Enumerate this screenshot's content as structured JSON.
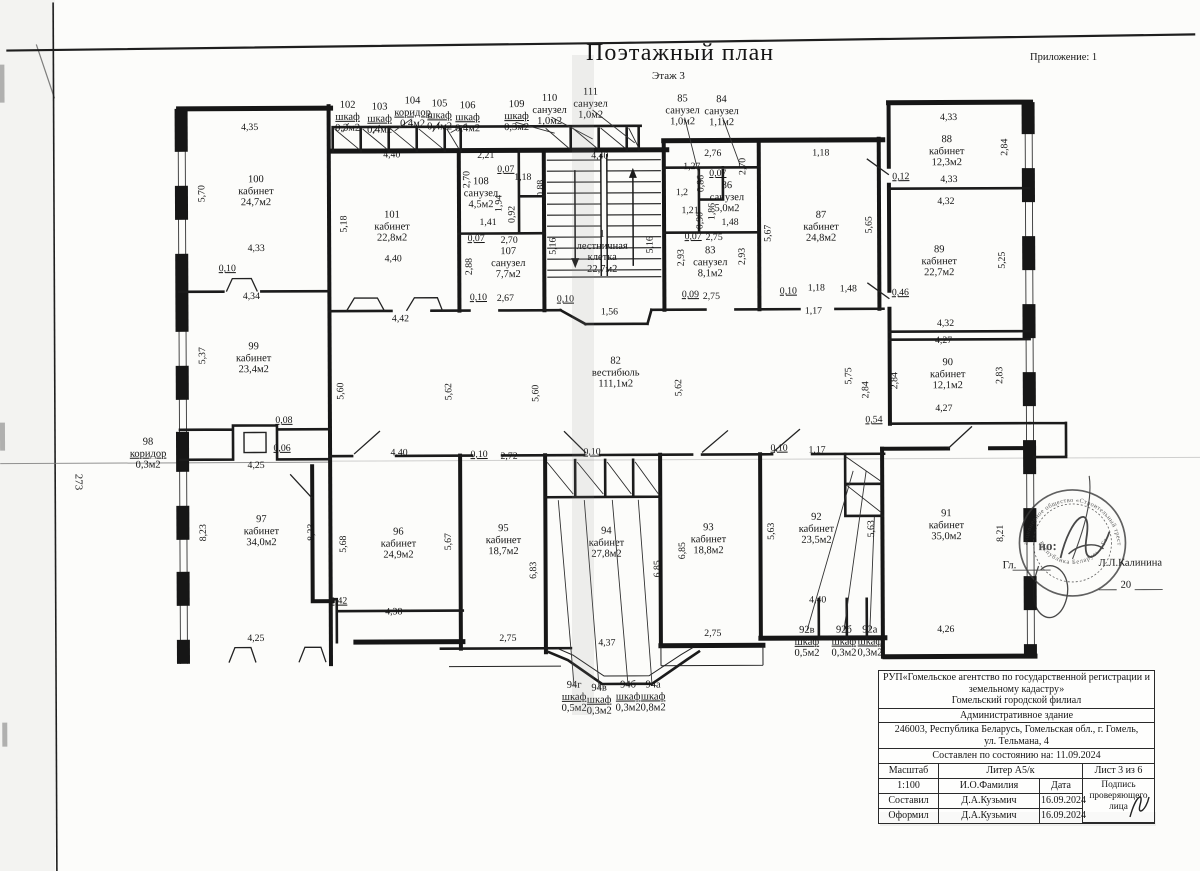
{
  "header": {
    "title": "Поэтажный план",
    "floor": "Этаж 3",
    "annex": "Приложение: 1"
  },
  "side_note": "273",
  "plan": {
    "rooms": [
      {
        "n": "100",
        "t": "кабинет",
        "a": "24,7м2",
        "x": 257,
        "y": 190
      },
      {
        "n": "101",
        "t": "кабинет",
        "a": "22,8м2",
        "x": 393,
        "y": 226
      },
      {
        "n": "108",
        "t": "санузел",
        "a": "4,5м2",
        "x": 482,
        "y": 193
      },
      {
        "n": "107",
        "t": "санузел",
        "a": "7,7м2",
        "x": 509,
        "y": 263
      },
      {
        "n": "1",
        "t": "лестничная",
        "t2": "клетка",
        "a": "22,7м2",
        "x": 603,
        "y": 252
      },
      {
        "n": "86",
        "t": "санузел",
        "a": "5,0м2",
        "x": 728,
        "y": 198
      },
      {
        "n": "83",
        "t": "санузел",
        "a": "8,1м2",
        "x": 711,
        "y": 263
      },
      {
        "n": "87",
        "t": "кабинет",
        "a": "24,8м2",
        "x": 822,
        "y": 228
      },
      {
        "n": "88",
        "t": "кабинет",
        "a": "12,3м2",
        "x": 948,
        "y": 153
      },
      {
        "n": "89",
        "t": "кабинет",
        "a": "22,7м2",
        "x": 940,
        "y": 263
      },
      {
        "n": "90",
        "t": "кабинет",
        "a": "12,1м2",
        "x": 948,
        "y": 376
      },
      {
        "n": "82",
        "t": "вестибюль",
        "a": "111,1м2",
        "x": 616,
        "y": 373
      },
      {
        "n": "99",
        "t": "кабинет",
        "a": "23,4м2",
        "x": 254,
        "y": 357
      },
      {
        "n": "98",
        "t": "коридор",
        "a": "0,3м2",
        "x": 148,
        "y": 452,
        "u": 1
      },
      {
        "n": "97",
        "t": "кабинет",
        "a": "34,0м2",
        "x": 261,
        "y": 530
      },
      {
        "n": "96",
        "t": "кабинет",
        "a": "24,9м2",
        "x": 398,
        "y": 543
      },
      {
        "n": "95",
        "t": "кабинет",
        "a": "18,7м2",
        "x": 503,
        "y": 540
      },
      {
        "n": "94",
        "t": "кабинет",
        "a": "27,8м2",
        "x": 606,
        "y": 543
      },
      {
        "n": "93",
        "t": "кабинет",
        "a": "18,8м2",
        "x": 708,
        "y": 540
      },
      {
        "n": "92",
        "t": "кабинет",
        "a": "23,5м2",
        "x": 816,
        "y": 530
      },
      {
        "n": "91",
        "t": "кабинет",
        "a": "35,0м2",
        "x": 946,
        "y": 527
      },
      {
        "n": "102",
        "t": "шкаф",
        "a": "0,3м2",
        "x": 349,
        "y": 116,
        "u": 1
      },
      {
        "n": "103",
        "t": "шкаф",
        "a": "0,4м2",
        "x": 381,
        "y": 118,
        "u": 1
      },
      {
        "n": "104",
        "t": "коридор",
        "a": "0,4м2",
        "x": 414,
        "y": 112,
        "u": 1
      },
      {
        "n": "105",
        "t": "шкаф",
        "a": "0,4м2",
        "x": 441,
        "y": 115,
        "u": 1
      },
      {
        "n": "106",
        "t": "шкаф",
        "a": "0,4м2",
        "x": 469,
        "y": 117,
        "u": 1
      },
      {
        "n": "109",
        "t": "шкаф",
        "a": "0,3м2",
        "x": 518,
        "y": 116,
        "u": 1
      },
      {
        "n": "110",
        "t": "санузел",
        "a": "1,0м2",
        "x": 551,
        "y": 110
      },
      {
        "n": "111",
        "t": "санузел",
        "a": "1,0м2",
        "x": 592,
        "y": 104
      },
      {
        "n": "85",
        "t": "санузел",
        "a": "1,0м2",
        "x": 684,
        "y": 111
      },
      {
        "n": "84",
        "t": "санузел",
        "a": "1,1м2",
        "x": 723,
        "y": 112
      },
      {
        "n": "92в",
        "t": "шкаф",
        "a": "0,5м2",
        "x": 806,
        "y": 643,
        "u": 1
      },
      {
        "n": "92б",
        "t": "шкаф",
        "a": "0,3м2",
        "x": 843,
        "y": 643,
        "u": 1
      },
      {
        "n": "92а",
        "t": "шкаф",
        "a": "0,3м2",
        "x": 869,
        "y": 643,
        "u": 1
      },
      {
        "n": "94г",
        "t": "шкаф",
        "a": "0,5м2",
        "x": 573,
        "y": 697,
        "u": 1
      },
      {
        "n": "94в",
        "t": "шкаф",
        "a": "0,3м2",
        "x": 598,
        "y": 700,
        "u": 1
      },
      {
        "n": "94б",
        "t": "шкаф",
        "a": "0,3м2",
        "x": 627,
        "y": 697,
        "u": 1
      },
      {
        "n": "94а",
        "t": "шкаф",
        "a": "0,8м2",
        "x": 652,
        "y": 697,
        "u": 1
      }
    ],
    "dims": [
      {
        "t": "4,35",
        "x": 251,
        "y": 126
      },
      {
        "t": "5,70",
        "x": 203,
        "y": 192,
        "r": 1
      },
      {
        "t": "4,33",
        "x": 257,
        "y": 247
      },
      {
        "t": "0,10",
        "x": 228,
        "y": 267,
        "u": 1
      },
      {
        "t": "4,34",
        "x": 252,
        "y": 295
      },
      {
        "t": "4,40",
        "x": 393,
        "y": 154
      },
      {
        "t": "5,18",
        "x": 345,
        "y": 223,
        "r": 1
      },
      {
        "t": "4,40",
        "x": 394,
        "y": 258
      },
      {
        "t": "4,42",
        "x": 401,
        "y": 318
      },
      {
        "t": "2,21",
        "x": 487,
        "y": 155
      },
      {
        "t": "0,07",
        "x": 507,
        "y": 169,
        "u": 1
      },
      {
        "t": "2,70",
        "x": 468,
        "y": 179,
        "r": 1
      },
      {
        "t": "1,18",
        "x": 524,
        "y": 177
      },
      {
        "t": "0,88",
        "x": 542,
        "y": 188,
        "r": 1
      },
      {
        "t": "1,94",
        "x": 500,
        "y": 203,
        "r": 1
      },
      {
        "t": "0,92",
        "x": 513,
        "y": 214,
        "r": 1
      },
      {
        "t": "1,41",
        "x": 489,
        "y": 222
      },
      {
        "t": "0,07",
        "x": 477,
        "y": 238,
        "u": 1
      },
      {
        "t": "2,70",
        "x": 510,
        "y": 240
      },
      {
        "t": "2,88",
        "x": 470,
        "y": 266,
        "r": 1
      },
      {
        "t": "0,10",
        "x": 479,
        "y": 297,
        "u": 1
      },
      {
        "t": "2,67",
        "x": 506,
        "y": 298
      },
      {
        "t": "4,40",
        "x": 601,
        "y": 156
      },
      {
        "t": "5,16",
        "x": 554,
        "y": 246,
        "r": 1
      },
      {
        "t": "5,16",
        "x": 651,
        "y": 245,
        "r": 1
      },
      {
        "t": "0,10",
        "x": 566,
        "y": 299,
        "u": 1
      },
      {
        "t": "1,56",
        "x": 610,
        "y": 312
      },
      {
        "t": "2,76",
        "x": 714,
        "y": 154
      },
      {
        "t": "1,27",
        "x": 693,
        "y": 167
      },
      {
        "t": "0,07",
        "x": 719,
        "y": 174,
        "u": 1
      },
      {
        "t": "2,70",
        "x": 744,
        "y": 167,
        "r": 1
      },
      {
        "t": "0,86",
        "x": 702,
        "y": 184,
        "r": 1
      },
      {
        "t": "1,2",
        "x": 683,
        "y": 193
      },
      {
        "t": "1,21",
        "x": 691,
        "y": 211
      },
      {
        "t": "0,90",
        "x": 701,
        "y": 221,
        "r": 1
      },
      {
        "t": "1,86",
        "x": 713,
        "y": 212,
        "r": 1
      },
      {
        "t": "1,48",
        "x": 731,
        "y": 223
      },
      {
        "t": "0,07",
        "x": 694,
        "y": 237,
        "u": 1
      },
      {
        "t": "2,75",
        "x": 715,
        "y": 238
      },
      {
        "t": "2,93",
        "x": 682,
        "y": 258,
        "r": 1
      },
      {
        "t": "2,93",
        "x": 743,
        "y": 257,
        "r": 1
      },
      {
        "t": "0,09",
        "x": 691,
        "y": 295,
        "u": 1
      },
      {
        "t": "2,75",
        "x": 712,
        "y": 297
      },
      {
        "t": "1,18",
        "x": 822,
        "y": 154
      },
      {
        "t": "5,67",
        "x": 769,
        "y": 234,
        "r": 1
      },
      {
        "t": "5,65",
        "x": 870,
        "y": 226,
        "r": 1
      },
      {
        "t": "0,10",
        "x": 789,
        "y": 292,
        "u": 1
      },
      {
        "t": "1,18",
        "x": 817,
        "y": 289
      },
      {
        "t": "1,48",
        "x": 849,
        "y": 290
      },
      {
        "t": "1,17",
        "x": 814,
        "y": 312
      },
      {
        "t": "4,33",
        "x": 950,
        "y": 119
      },
      {
        "t": "2,84",
        "x": 1006,
        "y": 149,
        "r": 1
      },
      {
        "t": "0,12",
        "x": 902,
        "y": 178,
        "u": 1
      },
      {
        "t": "4,33",
        "x": 950,
        "y": 181
      },
      {
        "t": "4,32",
        "x": 947,
        "y": 203
      },
      {
        "t": "5,25",
        "x": 1003,
        "y": 262,
        "r": 1
      },
      {
        "t": "0,46",
        "x": 901,
        "y": 294,
        "u": 1
      },
      {
        "t": "4,32",
        "x": 946,
        "y": 325
      },
      {
        "t": "4,27",
        "x": 944,
        "y": 342
      },
      {
        "t": "2,83",
        "x": 1000,
        "y": 377,
        "r": 1
      },
      {
        "t": "2,84",
        "x": 895,
        "y": 382,
        "r": 1
      },
      {
        "t": "4,27",
        "x": 944,
        "y": 410
      },
      {
        "t": "0,54",
        "x": 874,
        "y": 421,
        "u": 1
      },
      {
        "t": "5,60",
        "x": 341,
        "y": 390,
        "r": 1
      },
      {
        "t": "5,62",
        "x": 449,
        "y": 391,
        "r": 1
      },
      {
        "t": "5,60",
        "x": 536,
        "y": 393,
        "r": 1
      },
      {
        "t": "5,62",
        "x": 679,
        "y": 388,
        "r": 1
      },
      {
        "t": "5,75",
        "x": 849,
        "y": 377,
        "r": 1
      },
      {
        "t": "2,84",
        "x": 866,
        "y": 391,
        "r": 1
      },
      {
        "t": "5,37",
        "x": 203,
        "y": 354,
        "r": 1
      },
      {
        "t": "0,08",
        "x": 284,
        "y": 419,
        "u": 1
      },
      {
        "t": "0,06",
        "x": 282,
        "y": 447,
        "u": 1
      },
      {
        "t": "4,25",
        "x": 256,
        "y": 464
      },
      {
        "t": "8,23",
        "x": 203,
        "y": 531,
        "r": 1
      },
      {
        "t": "8,23",
        "x": 311,
        "y": 531,
        "r": 1
      },
      {
        "t": "5,68",
        "x": 343,
        "y": 543,
        "r": 1
      },
      {
        "t": "0,42",
        "x": 338,
        "y": 600,
        "u": 1
      },
      {
        "t": "4,38",
        "x": 393,
        "y": 611
      },
      {
        "t": "4,25",
        "x": 255,
        "y": 637
      },
      {
        "t": "4,40",
        "x": 399,
        "y": 452
      },
      {
        "t": "0,10",
        "x": 479,
        "y": 454,
        "u": 1
      },
      {
        "t": "2,72",
        "x": 509,
        "y": 456
      },
      {
        "t": "0,10",
        "x": 592,
        "y": 452,
        "u": 1
      },
      {
        "t": "0,10",
        "x": 779,
        "y": 449,
        "u": 1
      },
      {
        "t": "1,17",
        "x": 817,
        "y": 451
      },
      {
        "t": "5,67",
        "x": 448,
        "y": 541,
        "r": 1
      },
      {
        "t": "6,83",
        "x": 533,
        "y": 570,
        "r": 1
      },
      {
        "t": "2,75",
        "x": 507,
        "y": 638
      },
      {
        "t": "6,85",
        "x": 657,
        "y": 569,
        "r": 1
      },
      {
        "t": "4,37",
        "x": 606,
        "y": 643
      },
      {
        "t": "6,85",
        "x": 682,
        "y": 551,
        "r": 1
      },
      {
        "t": "2,75",
        "x": 712,
        "y": 634
      },
      {
        "t": "5,63",
        "x": 771,
        "y": 532,
        "r": 1
      },
      {
        "t": "5,63",
        "x": 871,
        "y": 530,
        "r": 1
      },
      {
        "t": "4,40",
        "x": 817,
        "y": 601
      },
      {
        "t": "8,21",
        "x": 1000,
        "y": 535,
        "r": 1
      },
      {
        "t": "4,26",
        "x": 945,
        "y": 631
      }
    ]
  },
  "stamp": {
    "ring_top": "акционерное общество «Строительный трест № 14»",
    "ring_bottom": "Республика Беларусь · Гомель",
    "center": "но:",
    "gl": "Гл.",
    "name": "Л.Л.Калинина",
    "year": "20"
  },
  "titleblock": {
    "org": "РУП«Гомельское агентство по государственной регистрации и земельному кадастру»",
    "branch": "Гомельский городской филиал",
    "building": "Административное здание",
    "address": "246003, Республика Беларусь, Гомельская обл., г. Гомель,",
    "address2": "ул. Тельмана, 4",
    "status": "Составлен по состоянию на: 11.09.2024",
    "scale_label": "Масштаб",
    "liter": "Литер А5/к",
    "sheet": "Лист  3 из 6",
    "scale": "1:100",
    "name_col": "И.О.Фамилия",
    "date_col": "Дата",
    "sign1": "Подпись",
    "sign2": "проверяющего",
    "sign3": "лица",
    "row1_label": "Составил",
    "row1_name": "Д.А.Кузьмич",
    "row1_date": "16.09.2024",
    "row2_label": "Оформил",
    "row2_name": "Д.А.Кузьмич",
    "row2_date": "16.09.2024"
  }
}
